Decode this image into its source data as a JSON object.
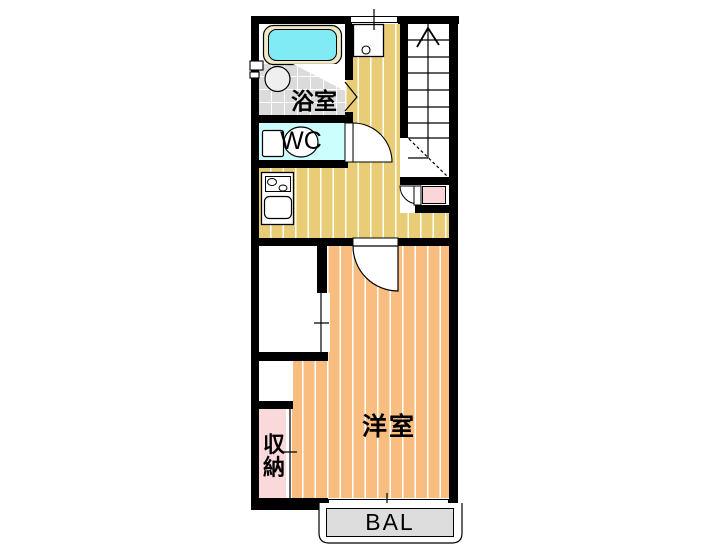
{
  "floorplan": {
    "rooms": {
      "bathroom": {
        "label": "浴室"
      },
      "toilet": {
        "label": "WC"
      },
      "western_room": {
        "label": "洋室"
      },
      "storage": {
        "label": "収納",
        "chars": [
          "収",
          "納"
        ]
      },
      "balcony": {
        "label": "BAL"
      }
    },
    "colors": {
      "wall": "#000000",
      "hall-floor": "#E9CC76",
      "room-floor": "#FABD80",
      "wc-floor": "#CCFEFE",
      "tile-floor": "#DBDBDB",
      "storage-floor": "#FAD9DB",
      "entry-floor": "#FBD6D9",
      "balcony-floor": "#DDDDDD",
      "tub-rim": "#F0E9C8",
      "tub-water": "#80EAF5",
      "fixture-fill": "#EFEFEF"
    }
  }
}
